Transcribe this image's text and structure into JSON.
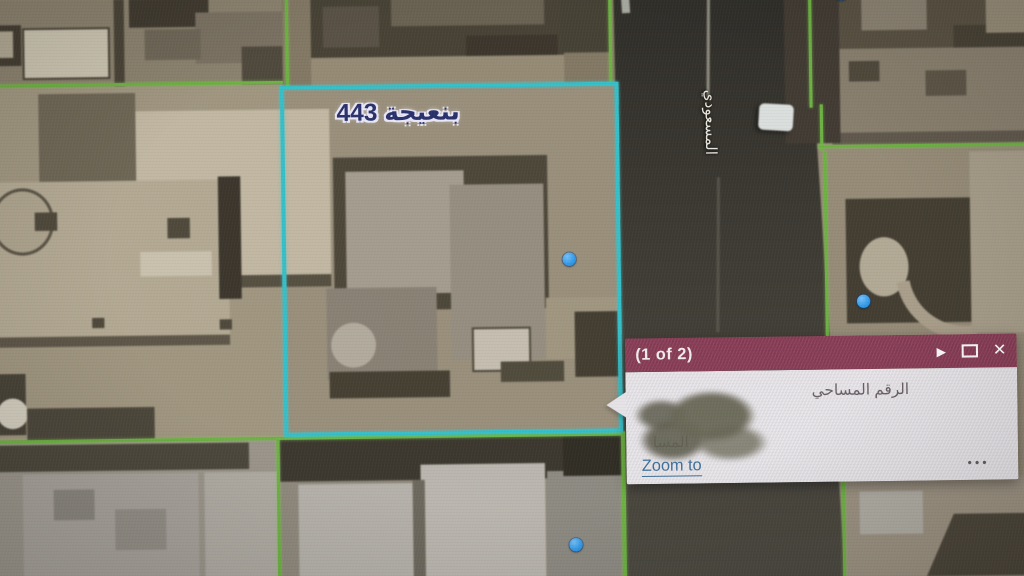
{
  "map": {
    "parcel_label": "بنعيجة 443",
    "street_label": "المسعودي",
    "selected_parcel_color": "#2fc3cc",
    "boundary_color": "#6ab43c",
    "marker_color": "#2f9ff2",
    "markers": [
      {
        "x": 839,
        "y": 4
      },
      {
        "x": 569,
        "y": 261
      },
      {
        "x": 857,
        "y": 306
      },
      {
        "x": 572,
        "y": 541
      }
    ]
  },
  "popup": {
    "pagination": "(1 of 2)",
    "header_color": "#8c3a55",
    "next_glyph": "▶",
    "maximize_icon": "square-outline",
    "close_glyph": "✕",
    "field_line_1": "الرقم المساحي",
    "field_line_2": "المسا",
    "redaction": "scribbled-blob",
    "zoom_to_label": "Zoom to",
    "more_options_glyph": "•••",
    "link_color": "#3a709d"
  }
}
